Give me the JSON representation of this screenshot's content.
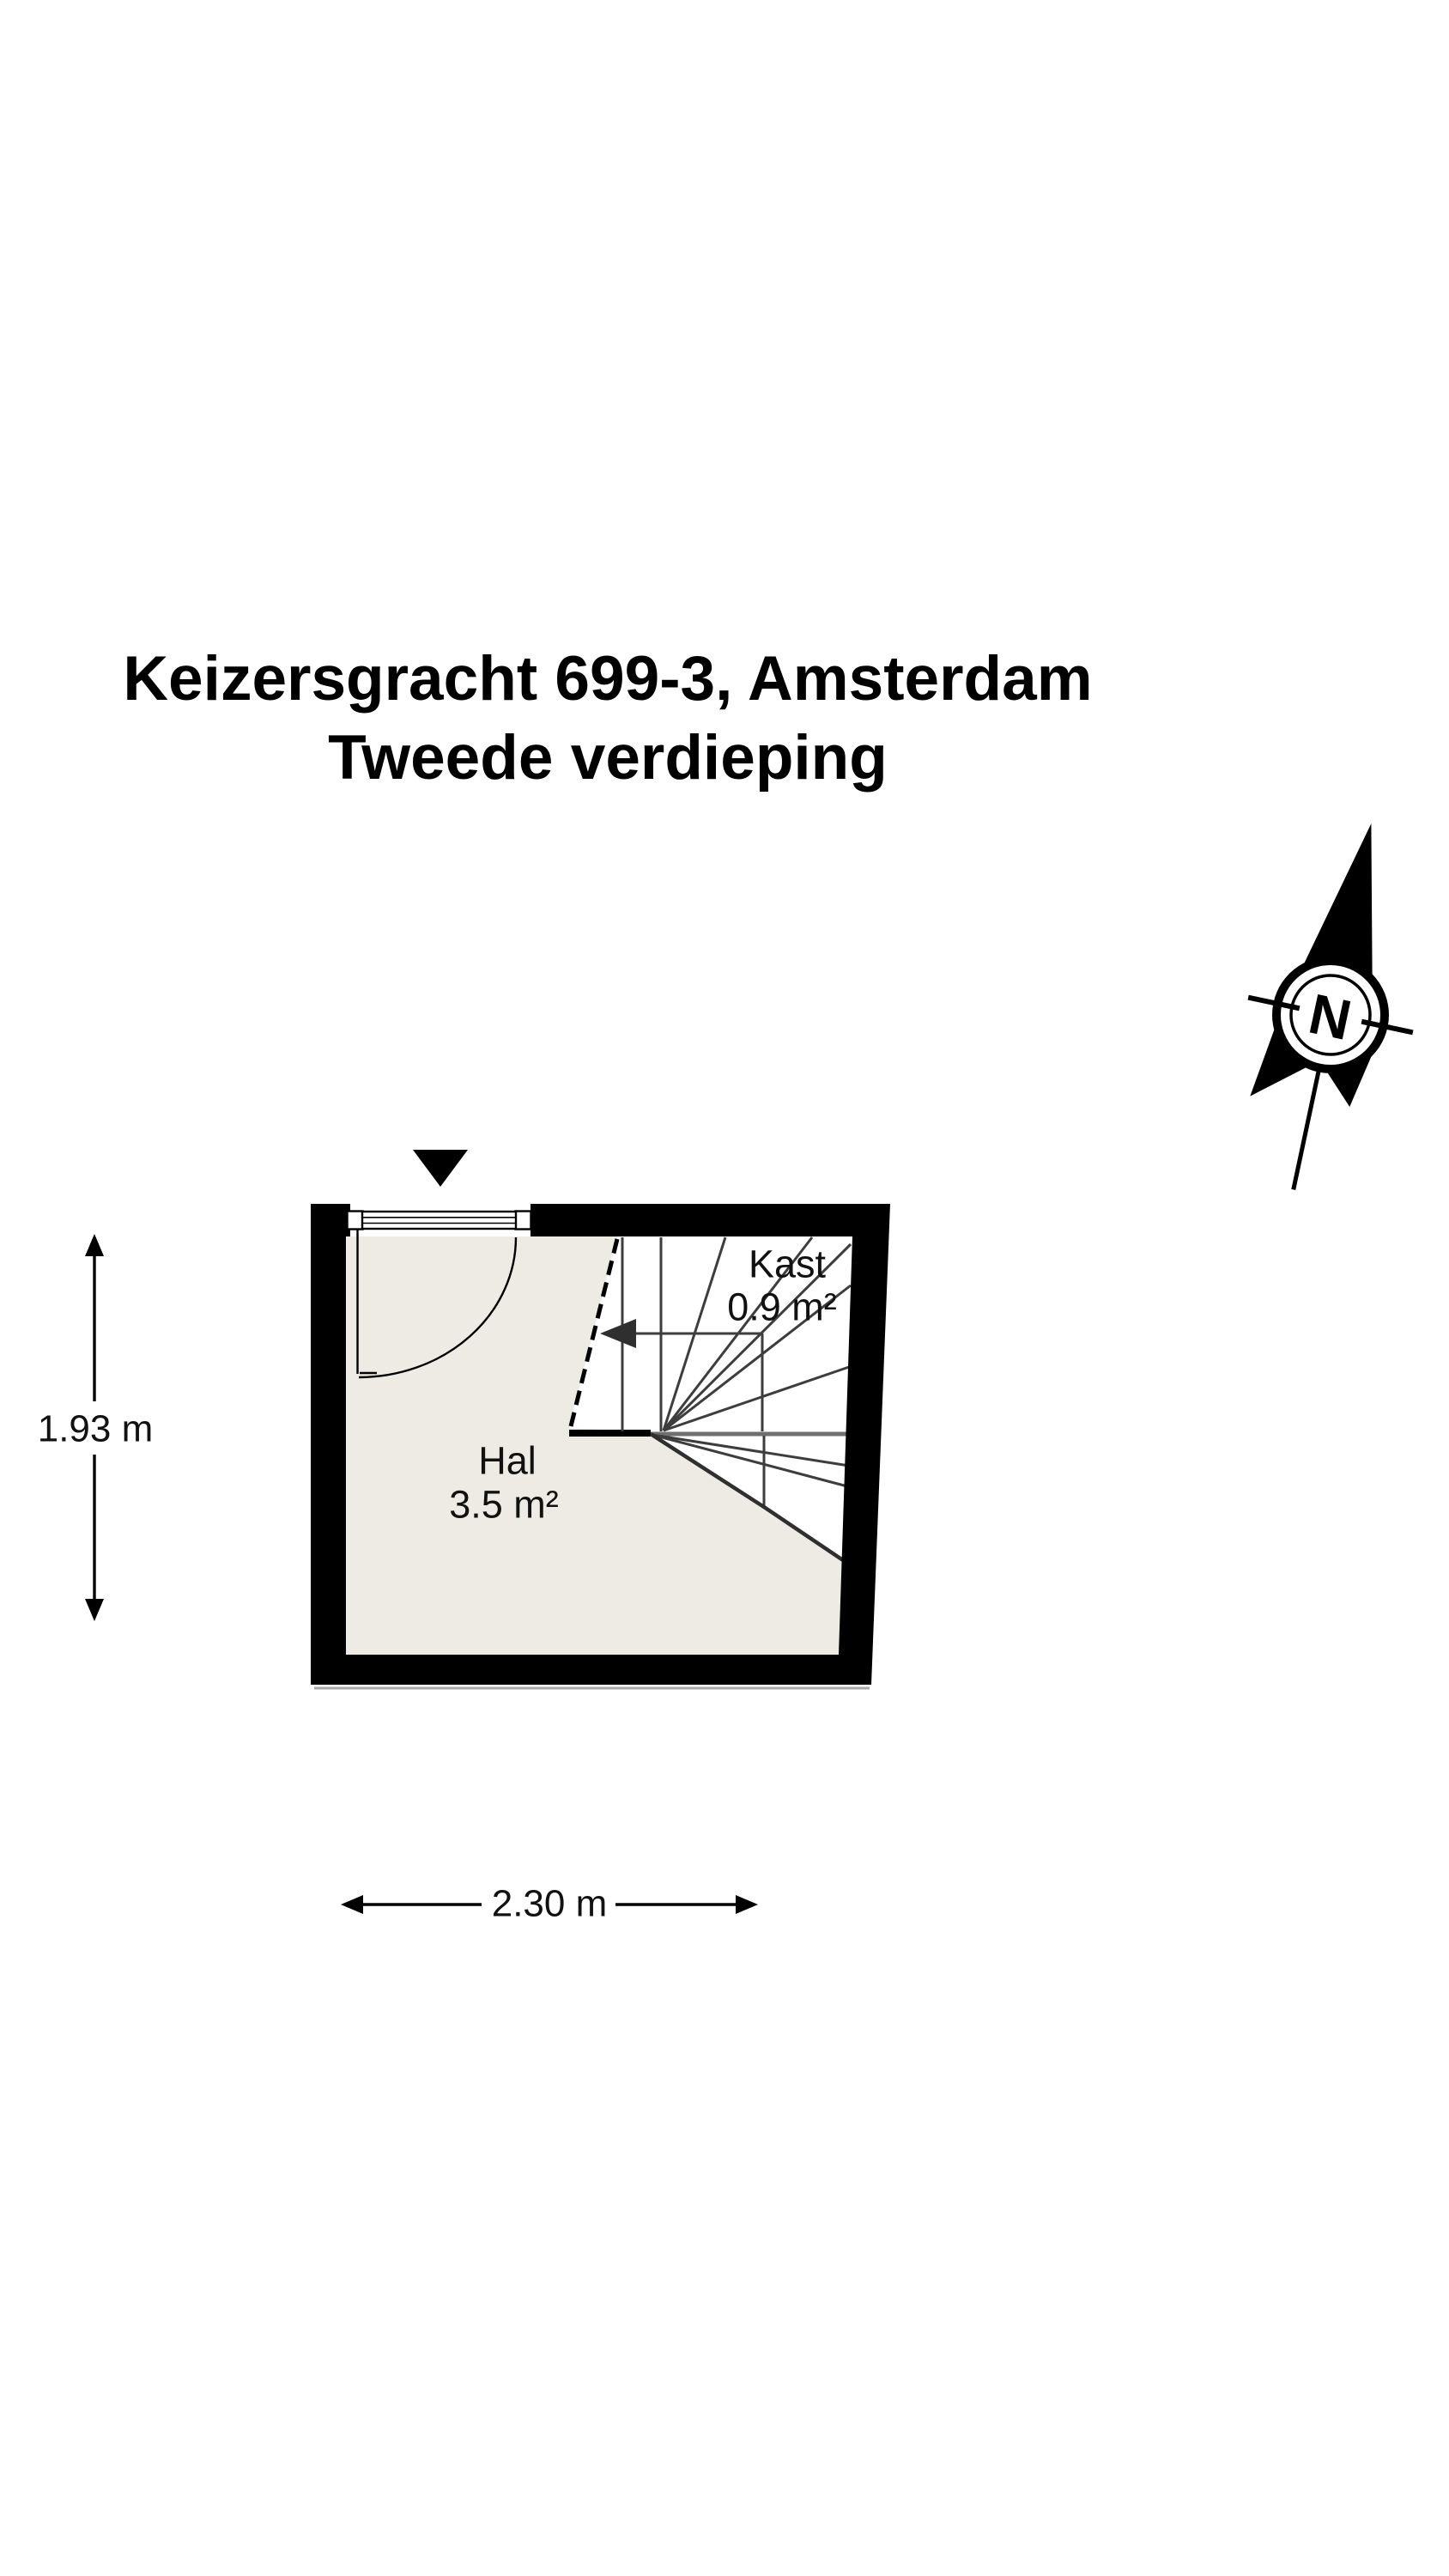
{
  "title": {
    "line1": "Keizersgracht 699-3, Amsterdam",
    "line2": "Tweede verdieping"
  },
  "compass": {
    "label": "N"
  },
  "floor_plan": {
    "rooms": [
      {
        "name": "Hal",
        "area": "3.5 m²"
      },
      {
        "name": "Kast",
        "area": "0.9 m²"
      }
    ],
    "dimensions": {
      "vertical": "1.93 m",
      "horizontal": "2.30 m"
    }
  },
  "colors": {
    "background": "#ffffff",
    "wall": "#000000",
    "floor": "#edebe3",
    "stair_line": "#3d3d3d",
    "step_edge": "#6f6f6f",
    "text": "#111111"
  }
}
